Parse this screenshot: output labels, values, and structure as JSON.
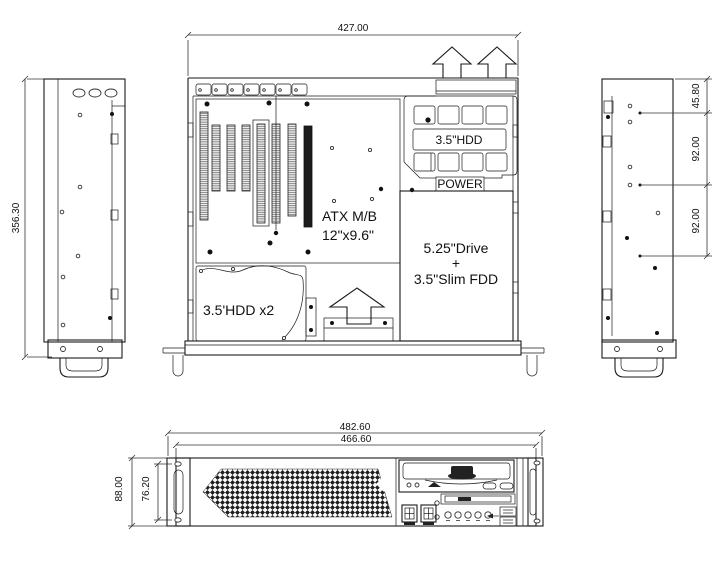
{
  "views": {
    "top": {
      "width_dim": "427.00",
      "hdd_bay_label": "3.5\"HDD",
      "power_label": "POWER",
      "motherboard_line1": "ATX M/B",
      "motherboard_line2": "12\"x9.6\"",
      "drive_bay_line1": "5.25\"Drive",
      "drive_bay_line2": "+",
      "drive_bay_line3": "3.5\"Slim FDD",
      "hdd_x2_label": "3.5'HDD x2"
    },
    "left_side": {
      "height_dim": "356.30"
    },
    "right_side": {
      "dim_top": "45.80",
      "dim_mid": "92.00",
      "dim_bottom": "92.00"
    },
    "front": {
      "outer_width_dim": "482.60",
      "inner_width_dim": "466.60",
      "height_dim": "88.00",
      "hole_spacing_dim": "76.20"
    }
  }
}
